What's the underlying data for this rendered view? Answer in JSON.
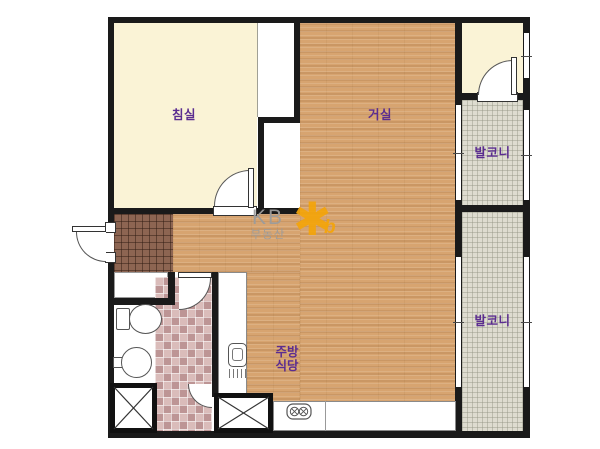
{
  "rooms": {
    "bedroom": "침실",
    "living_room": "거실",
    "balcony_top": "발코니",
    "balcony_right": "발코니",
    "kitchen_line1": "주방",
    "kitchen_line2": "식당"
  },
  "watermark": {
    "brand": "KB",
    "brand_sub": "부동산",
    "logo_star": "✱",
    "logo_b": "b"
  },
  "colors": {
    "wall": "#1a1a1a",
    "bedroom_floor": "#faf3d6",
    "wood_floor": "#d7a470",
    "entry_tile": "#8d6552",
    "bathroom_tile": "#cba6a4",
    "balcony_tile": "#dedcd0",
    "room_label": "#5b2d90",
    "watermark_gray": "#9c9c9c",
    "logo_orange": "#f4a50a"
  }
}
